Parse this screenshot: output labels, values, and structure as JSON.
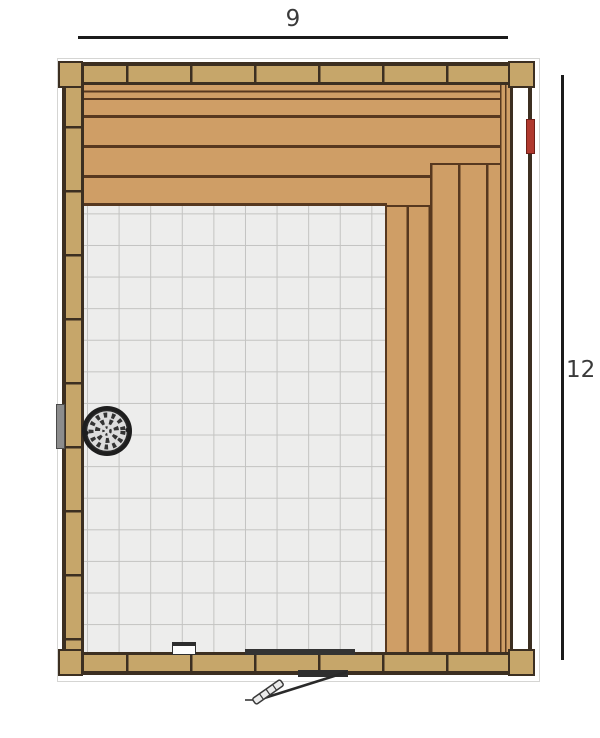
{
  "dimension_labels": {
    "width": "9",
    "height": "12"
  },
  "colors": {
    "wall-wood": "#c6a66a",
    "wall-outline": "#3c2f21",
    "bench-wood": "#cf9e66",
    "plank-gap": "#57381f",
    "floor": "#ededec",
    "floor-grid": "#c3c3c1",
    "dim-line": "#1b1b1b",
    "dim-text": "#3a3a3a",
    "heater-dark": "#1e1e1e",
    "heater-stones": "#dcdcdc",
    "accent-red": "#b0392e",
    "fixture-gray": "#8c8c8c",
    "door-dark": "#333333"
  }
}
